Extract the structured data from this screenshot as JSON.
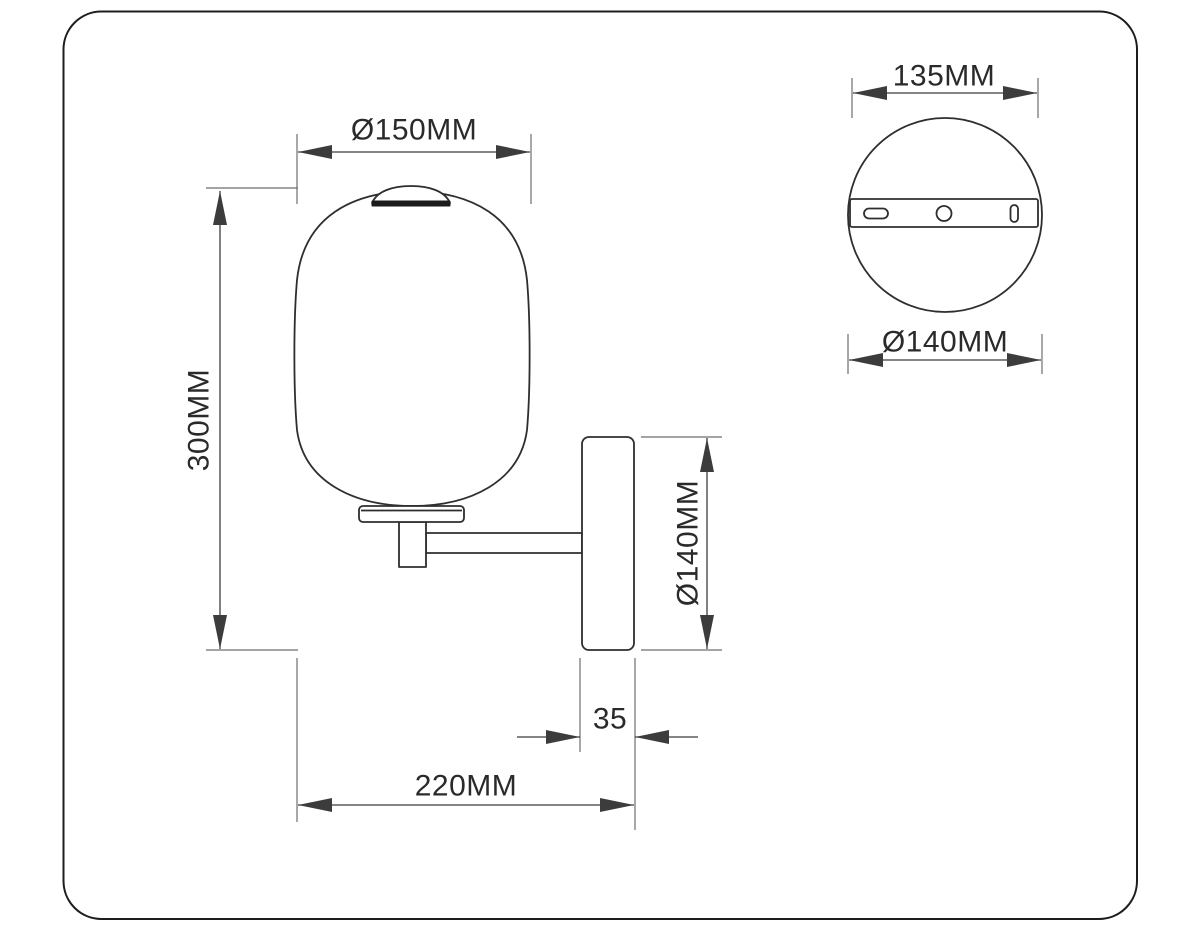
{
  "labels": {
    "shade_diameter": "Ø150MM",
    "total_height": "300MM",
    "backplate_height": "Ø140MM",
    "backplate_depth": "35",
    "total_projection": "220MM",
    "bracket_length": "135MM",
    "backplate_diameter": "Ø140MM"
  },
  "colors": {
    "object_line": "#2e2e2e",
    "dim_line": "#3c3c3c",
    "ext_line": "#6e6e6e",
    "text": "#2a2a2a",
    "cap_band": "#1b1b1b",
    "border": "#1d1d1d",
    "background": "#ffffff"
  }
}
